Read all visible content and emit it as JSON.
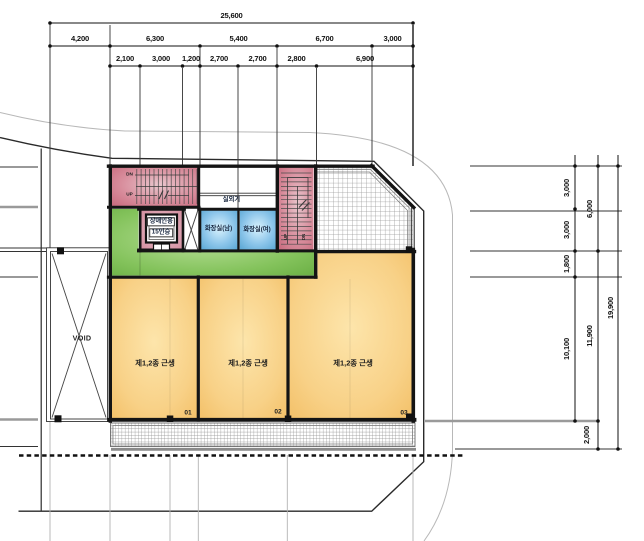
{
  "dims": {
    "top1": [
      "25,600"
    ],
    "top2": [
      "4,200",
      "6,300",
      "5,400",
      "6,700",
      "3,000"
    ],
    "top3": [
      "2,100",
      "3,000",
      "1,200",
      "2,700",
      "2,700",
      "2,800",
      "6,900"
    ],
    "right1": [
      "3,000",
      "3,000",
      "1,800",
      "10,100"
    ],
    "right2": [
      "6,000",
      "11,900"
    ],
    "right3": [
      "19,900"
    ],
    "bottom_right": "2,000"
  },
  "labels": {
    "outdoor_unit": "실외기",
    "restroom_men": "화장실(남)",
    "restroom_women": "화장실(여)",
    "elevator_line1": "장애인용",
    "elevator_line2": "15인승",
    "retail_room": "제1,2종 근생",
    "unit_01": "01",
    "unit_02": "02",
    "unit_03": "03",
    "void": "VOID",
    "dn": "DN",
    "up": "UP"
  },
  "colors": {
    "wall": "#141414",
    "stair_pink": "#cf7487",
    "elevator_pink": "#d795a5",
    "restroom_blue": "#6fb6e0",
    "corridor_green": "#79bb52",
    "retail_orange": "#f5c873",
    "hatch_gray": "#8a8a8a",
    "road_gray": "#b8b8b8"
  }
}
